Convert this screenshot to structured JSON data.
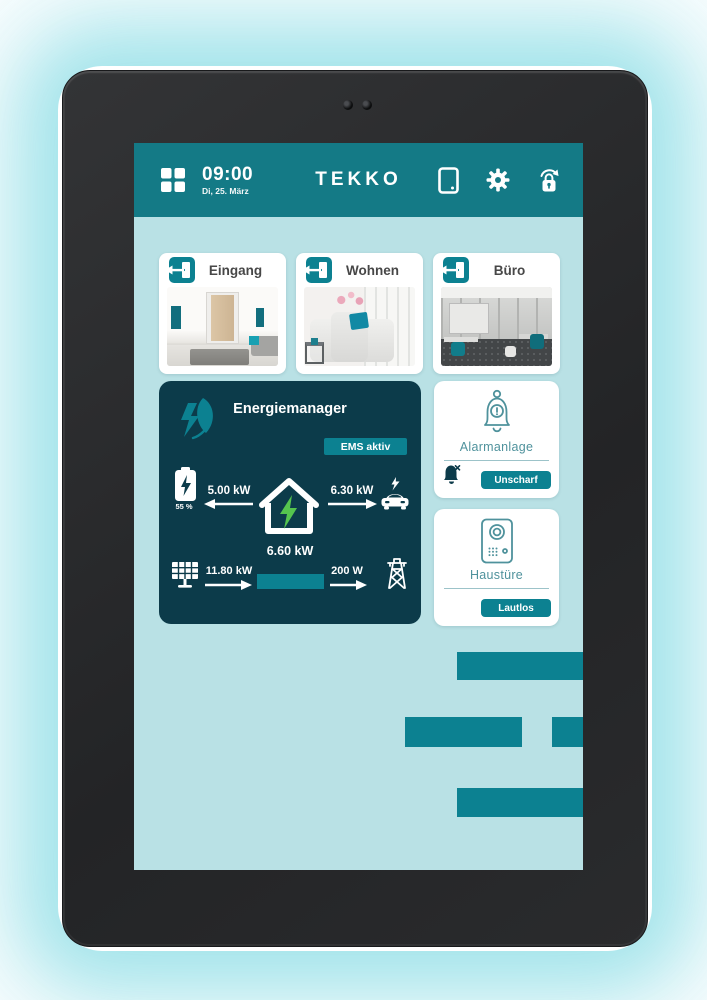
{
  "colors": {
    "header_teal": "#147a86",
    "screen_bg": "#b9e1e5",
    "panel_dark": "#0c3b4a",
    "accent_teal": "#0c8191",
    "green_bolt": "#55c44e",
    "card_text": "#474747",
    "teal_text": "#4f929c",
    "divider": "#9cc3c9",
    "tablet_body": "#2b2c2e",
    "glow": "#a9e5eb"
  },
  "header": {
    "time": "09:00",
    "date": "Di, 25. März",
    "title": "TEKKO"
  },
  "icons": {
    "menu": "grid-menu-icon",
    "device": "tablet-icon",
    "settings": "gear-icon",
    "lock": "lock-refresh-icon",
    "room": "door-exit-icon",
    "energy": "leaf-bolt-icon",
    "battery": "battery-icon",
    "house": "house-bolt-icon",
    "car": "ev-car-icon",
    "solar": "solar-panel-icon",
    "grid": "power-tower-icon",
    "alarm": "alarm-bell-icon",
    "alarm_off": "bell-off-icon",
    "intercom": "intercom-icon"
  },
  "rooms": [
    {
      "label": "Eingang"
    },
    {
      "label": "Wohnen"
    },
    {
      "label": "Büro"
    }
  ],
  "energy": {
    "title": "Energiemanager",
    "status_badge": "EMS aktiv",
    "battery_level": "55 %",
    "battery_flow": "5.00 kW",
    "ev_flow": "6.30 kW",
    "home_consumption": "6.60 kW",
    "pv_flow": "11.80 kW",
    "grid_flow": "200 W"
  },
  "alarm": {
    "title": "Alarmanlage",
    "button": "Unscharf"
  },
  "front_door": {
    "title": "Haustüre",
    "button": "Lautlos"
  }
}
